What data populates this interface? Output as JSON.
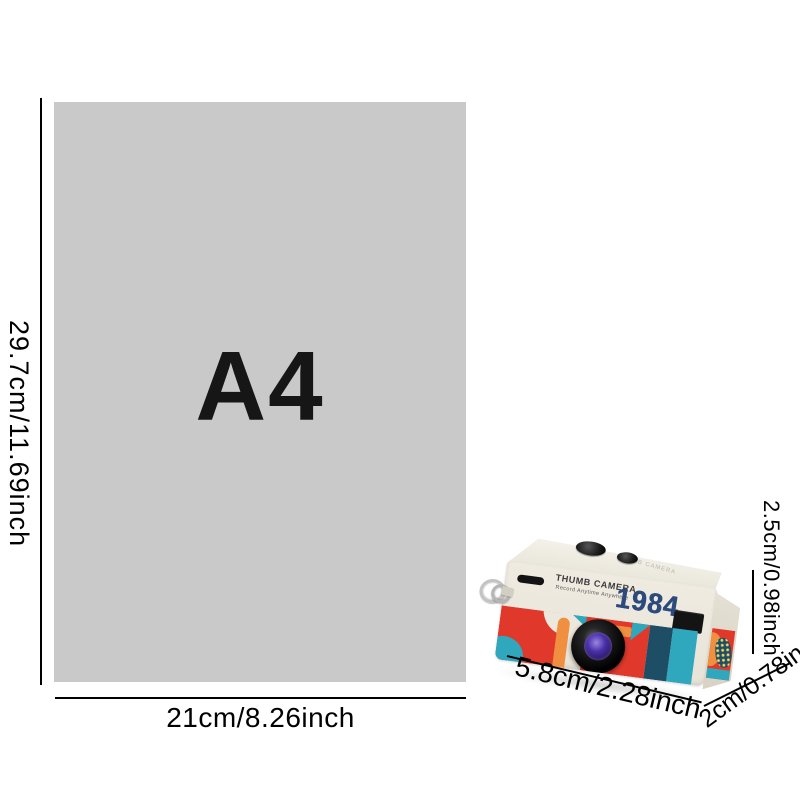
{
  "paper": {
    "name": "A4",
    "height_label": "29.7cm/11.69inch",
    "width_label": "21cm/8.26inch",
    "fill_color": "#c9c9c9"
  },
  "camera": {
    "brand": "THUMB CAMERA",
    "tagline": "Record Anytime Anywhere",
    "model_year": "1984",
    "top_emboss": "THUMB CAMERA",
    "width_label": "5.8cm/2.28inch",
    "depth_label": "2cm/0.78in",
    "height_label": "2.5cm/0.98inch",
    "colors": {
      "body_cream": "#ece8dd",
      "art_red": "#e0392c",
      "art_orange": "#ef8f3f",
      "art_teal": "#2fa7bd",
      "art_navy": "#1e4e66",
      "year_blue": "#2c4a7c",
      "lens_glass_purple": "#4a2fa8"
    }
  }
}
